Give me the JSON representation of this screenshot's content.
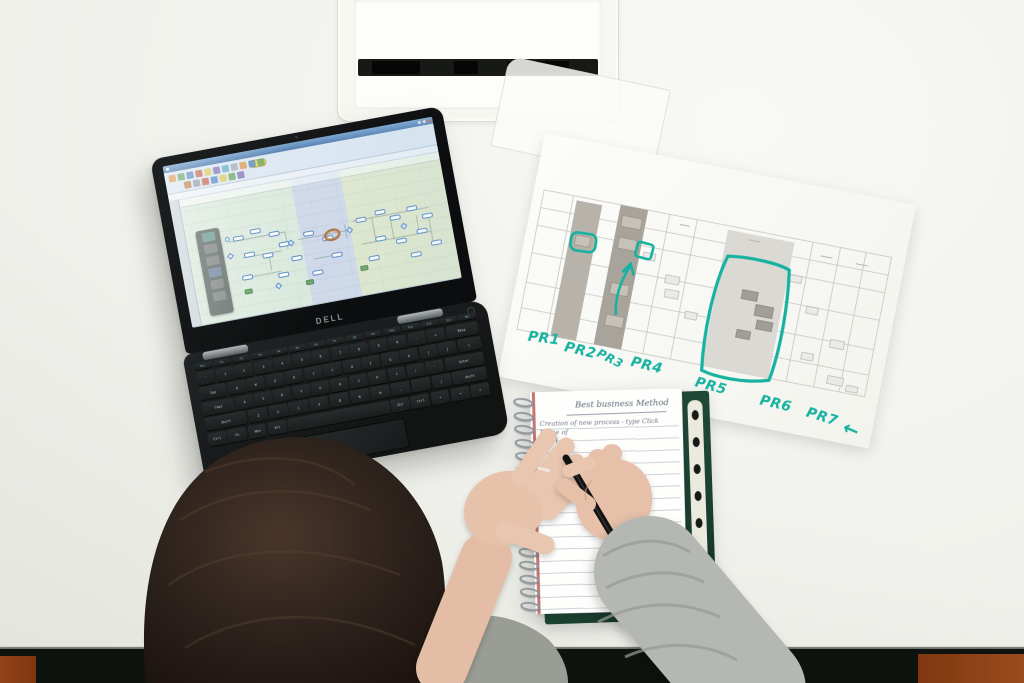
{
  "colors": {
    "desk": "#f1f2ec",
    "floor": "#96451b",
    "marker": "#15b2a0",
    "cover": "#1d4434",
    "hair": "#2b211c",
    "skin": "#e7c2ab",
    "sleeve": "#b5b8b2"
  },
  "laptop": {
    "brand": "DELL",
    "model_label": "Latitude",
    "keyboard_rows": [
      [
        "Esc",
        "F1",
        "F2",
        "F3",
        "F4",
        "F5",
        "F6",
        "F7",
        "F8",
        "F9",
        "F10",
        "F11",
        "F12",
        "Ins",
        "Del"
      ],
      [
        "`",
        "1",
        "2",
        "3",
        "4",
        "5",
        "6",
        "7",
        "8",
        "9",
        "0",
        "-",
        "=",
        "Bksp"
      ],
      [
        "Tab",
        "Q",
        "W",
        "E",
        "R",
        "T",
        "Y",
        "U",
        "I",
        "O",
        "P",
        "[",
        "]",
        "\\"
      ],
      [
        "Caps",
        "A",
        "S",
        "D",
        "F",
        "G",
        "H",
        "J",
        "K",
        "L",
        ";",
        "'",
        "Enter"
      ],
      [
        "Shift",
        "Z",
        "X",
        "C",
        "V",
        "B",
        "N",
        "M",
        ",",
        ".",
        "/",
        "Shift"
      ],
      [
        "Ctrl",
        "Fn",
        "Win",
        "Alt",
        "",
        "Alt",
        "Ctrl",
        "◂",
        "▾",
        "▸"
      ]
    ]
  },
  "screen": {
    "lane_colors": [
      "#cfe6d2",
      "#b9c4ea",
      "#dde4ae"
    ]
  },
  "paper": {
    "labels": [
      "PR1",
      "PR2",
      "PR3",
      "PR4",
      "PR5",
      "PR6",
      "PR7"
    ],
    "arrow": "←"
  },
  "notebook": {
    "title": "Best business Method",
    "notes": [
      "Creation of new process  -  type   Click",
      "Name of",
      "Level"
    ]
  }
}
